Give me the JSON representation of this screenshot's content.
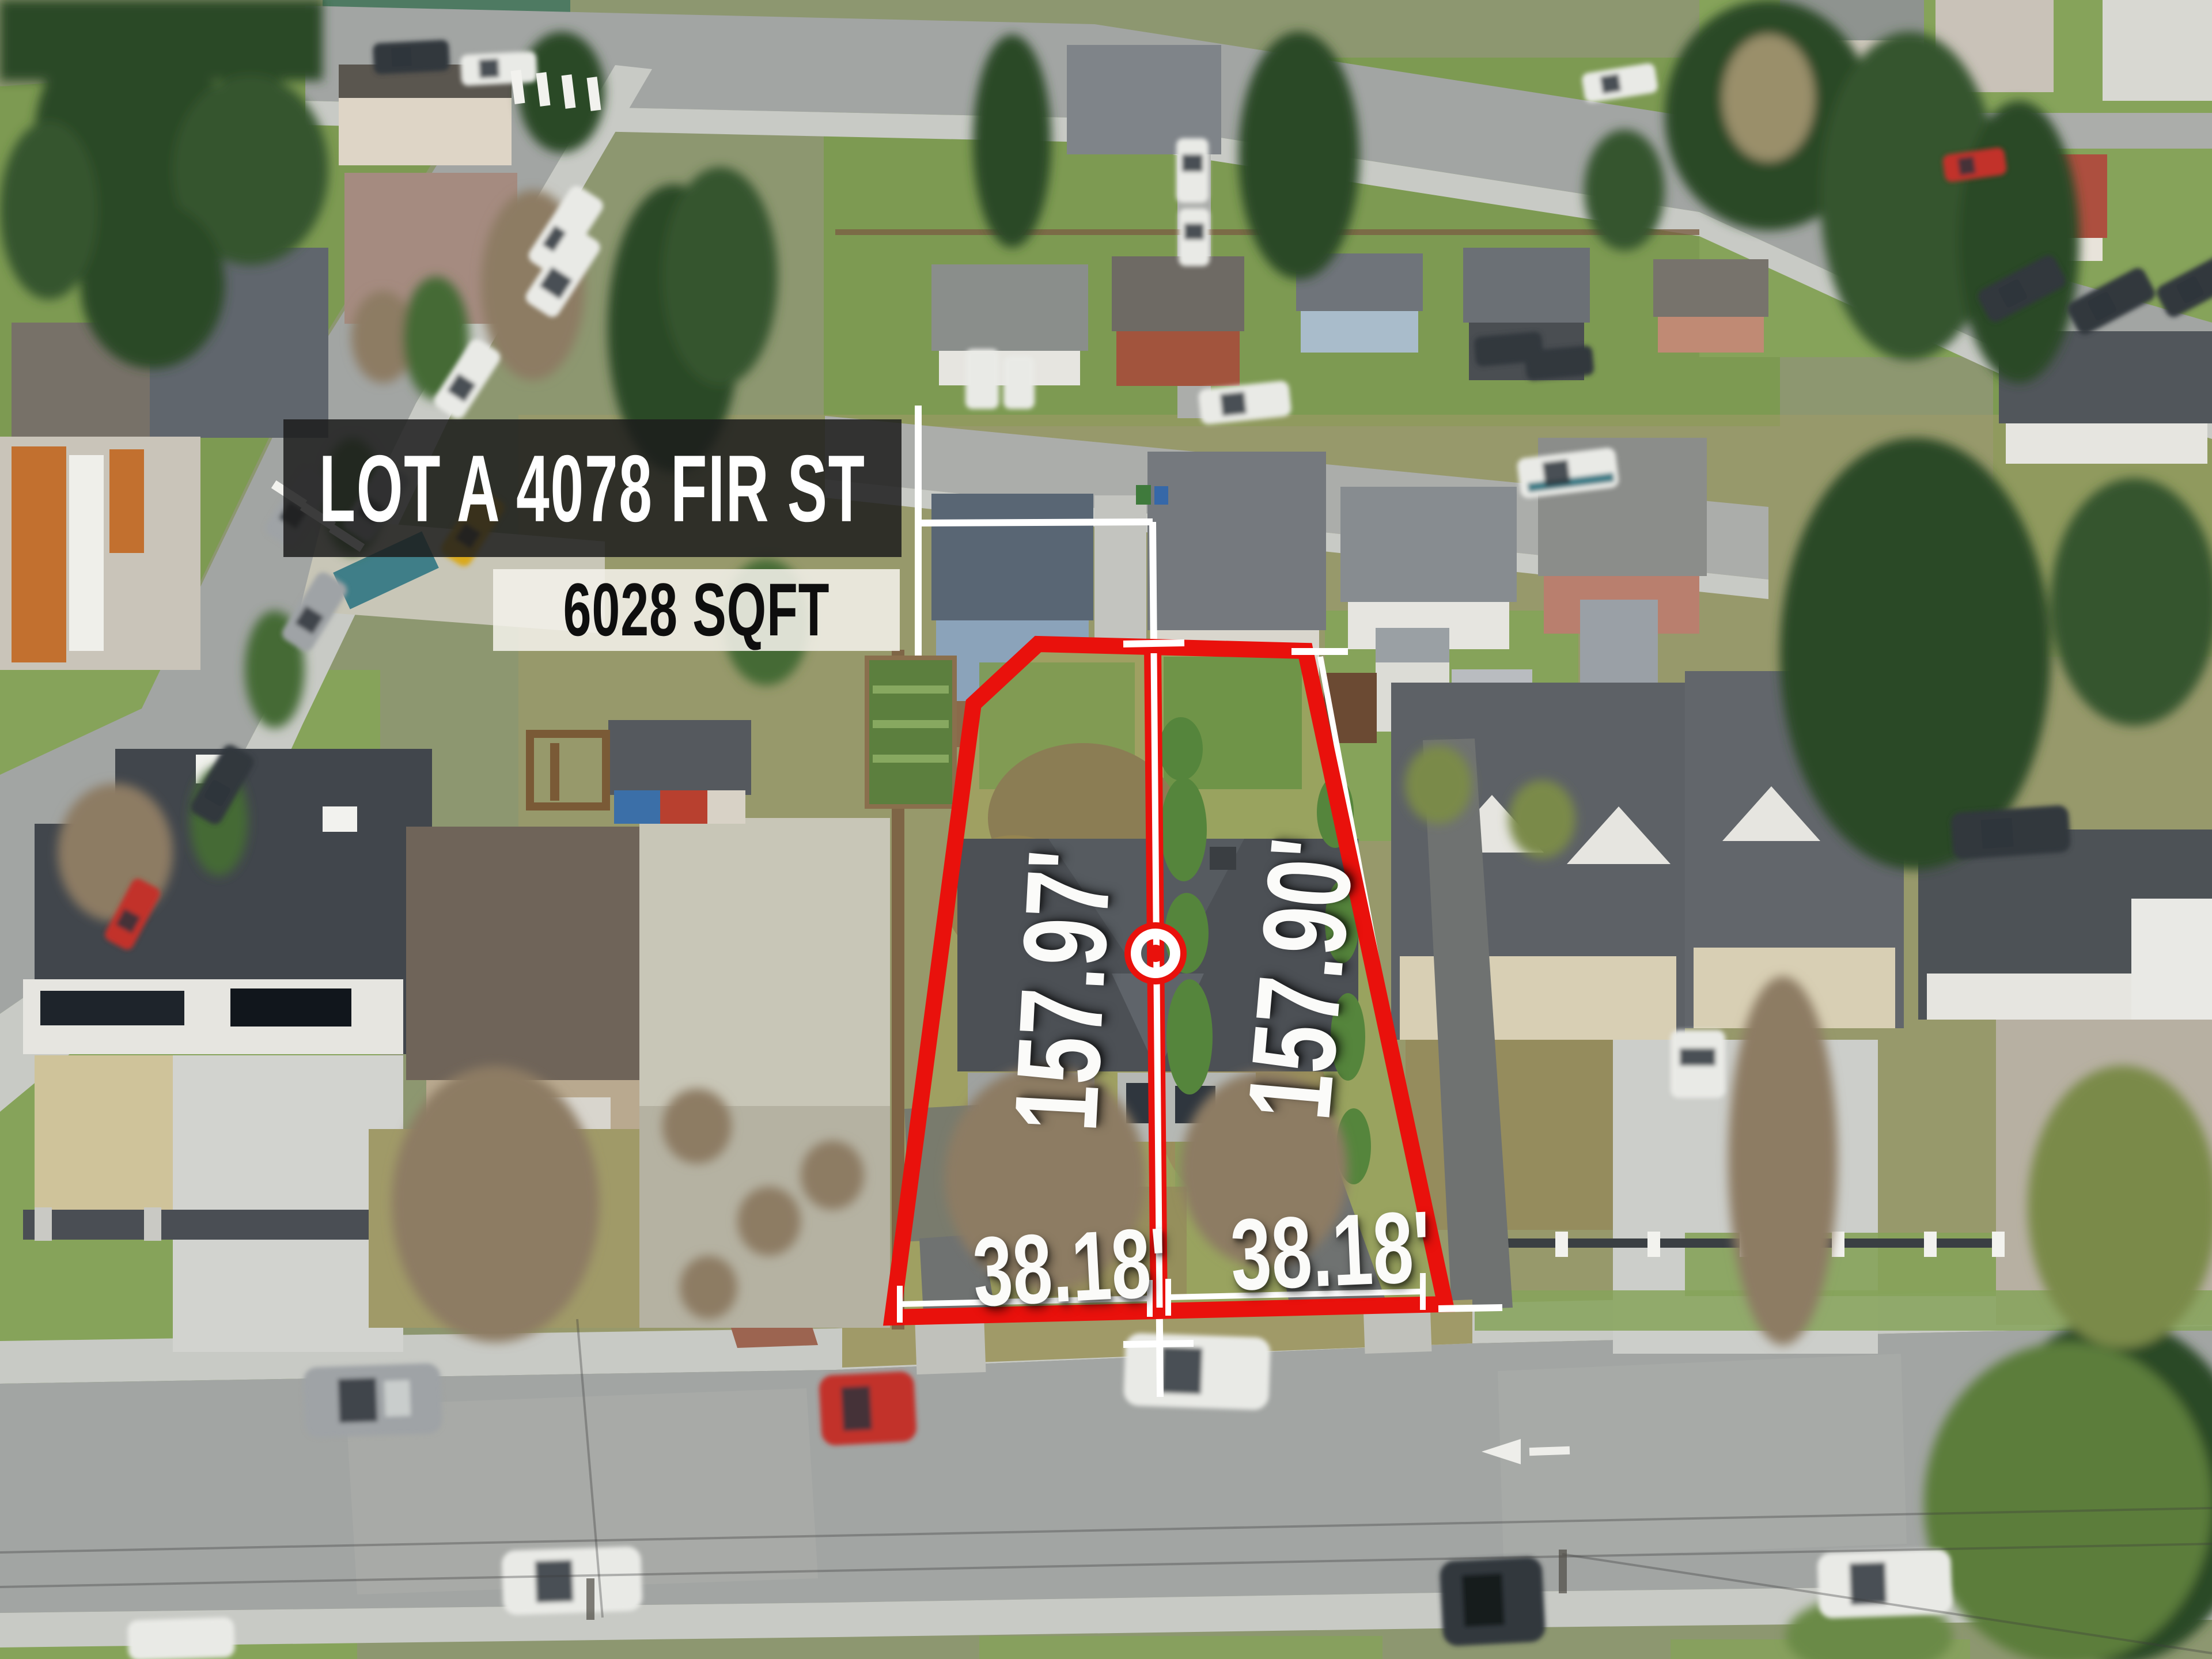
{
  "overlay": {
    "title": "LOT A 4078 FIR ST",
    "lot_size": "6028 SQFT",
    "measurements": {
      "left_depth": "157.97'",
      "right_depth": "157.90'",
      "left_frontage": "38.18'",
      "right_frontage": "38.18'"
    },
    "colors": {
      "boundary_red": "#e9110c",
      "survey_line_white": "#ffffff",
      "banner_bg": "rgba(28,28,28,0.85)",
      "banner_text": "#ffffff",
      "sqft_box_bg": "rgba(244,241,234,0.87)",
      "sqft_text": "#0e0e0e",
      "label_text": "#fbfbf9"
    },
    "markers": [
      "bullseye-marker"
    ]
  },
  "scene": {
    "palette": {
      "grass_green": "#7d9a52",
      "scrub_tan": "#a09a68",
      "asphalt_gray": "#a2a5a3",
      "concrete_light": "#c8cac5",
      "roof_charcoal": "#4c5055",
      "conifer_dark": "#2c4827"
    }
  }
}
